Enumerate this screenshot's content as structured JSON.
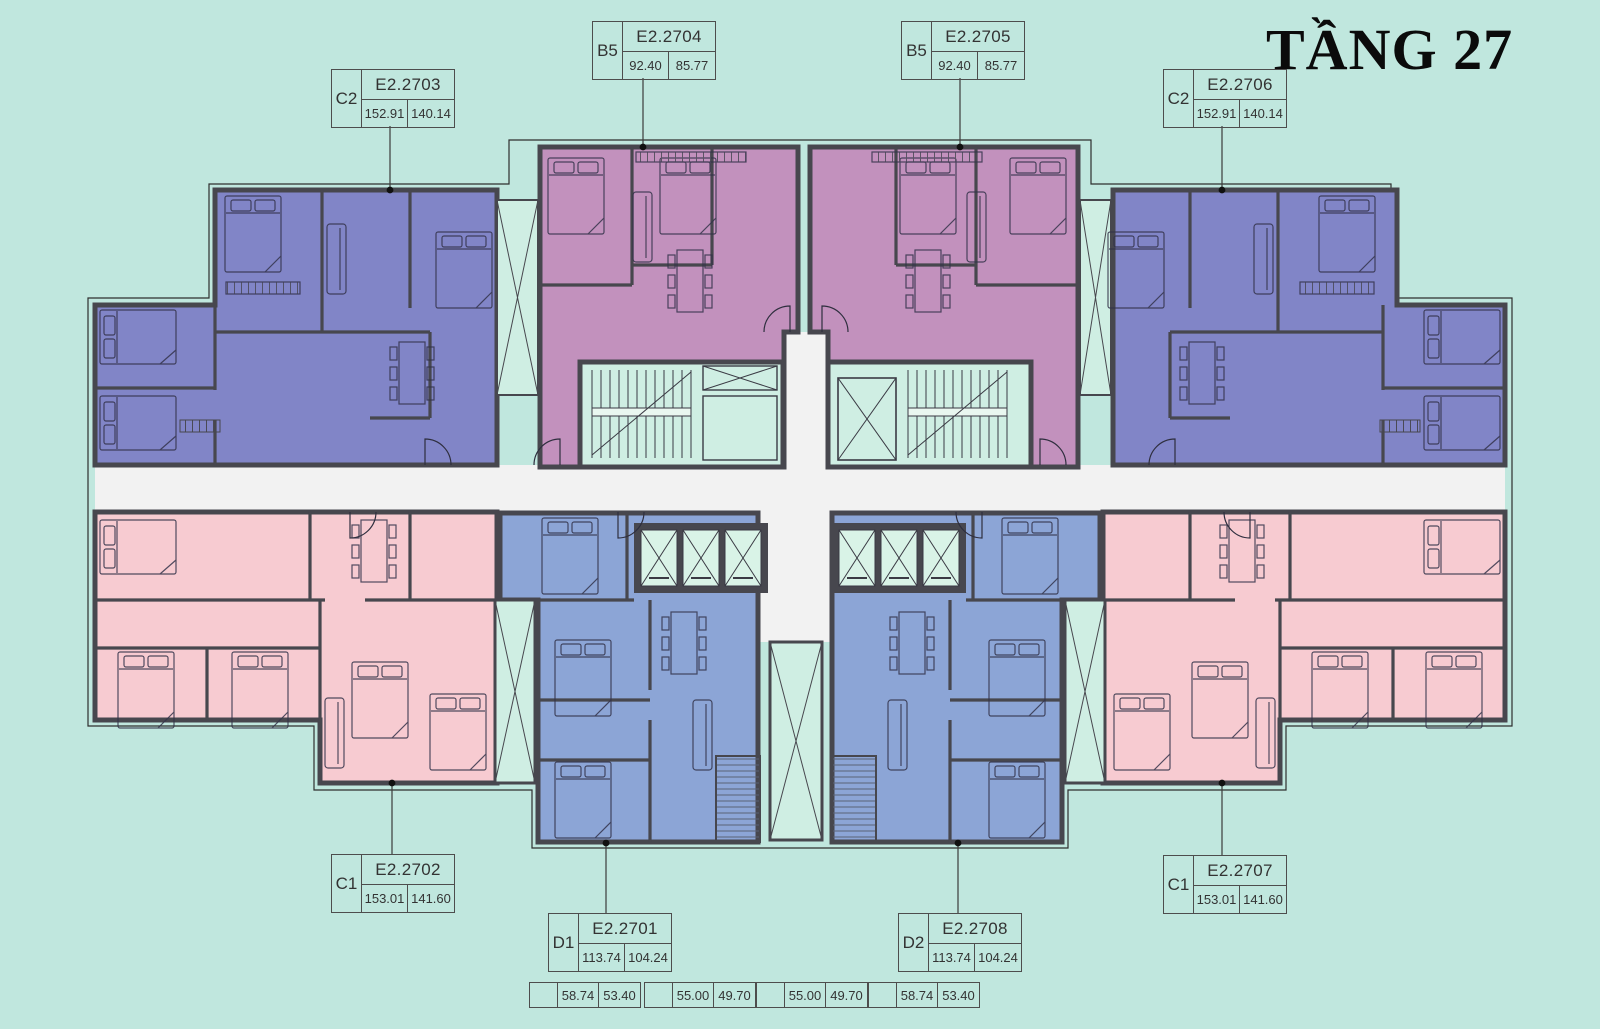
{
  "title": "TẦNG 27",
  "units": [
    {
      "type": "C2",
      "code": "E2.2703",
      "a1": "152.91",
      "a2": "140.14"
    },
    {
      "type": "B5",
      "code": "E2.2704",
      "a1": "92.40",
      "a2": "85.77"
    },
    {
      "type": "B5",
      "code": "E2.2705",
      "a1": "92.40",
      "a2": "85.77"
    },
    {
      "type": "C2",
      "code": "E2.2706",
      "a1": "152.91",
      "a2": "140.14"
    },
    {
      "type": "C1",
      "code": "E2.2702",
      "a1": "153.01",
      "a2": "141.60"
    },
    {
      "type": "D1",
      "code": "E2.2701",
      "a1": "113.74",
      "a2": "104.24"
    },
    {
      "type": "D2",
      "code": "E2.2708",
      "a1": "113.74",
      "a2": "104.24"
    },
    {
      "type": "C1",
      "code": "E2.2707",
      "a1": "153.01",
      "a2": "141.60"
    }
  ],
  "dims": [
    {
      "v1": "58.74",
      "v2": "53.40"
    },
    {
      "v1": "55.00",
      "v2": "49.70"
    },
    {
      "v1": "55.00",
      "v2": "49.70"
    },
    {
      "v1": "58.74",
      "v2": "53.40"
    }
  ],
  "colors": {
    "background": "#c0e7de",
    "unit_c2": "#8185c7",
    "unit_b5": "#c291bd",
    "unit_c1": "#f7cbd1",
    "unit_d": "#8ca5d6",
    "core": "#cfeee3",
    "cell": "#d9f3e7",
    "corridor": "#f2f2f2",
    "wall": "#47474e"
  }
}
